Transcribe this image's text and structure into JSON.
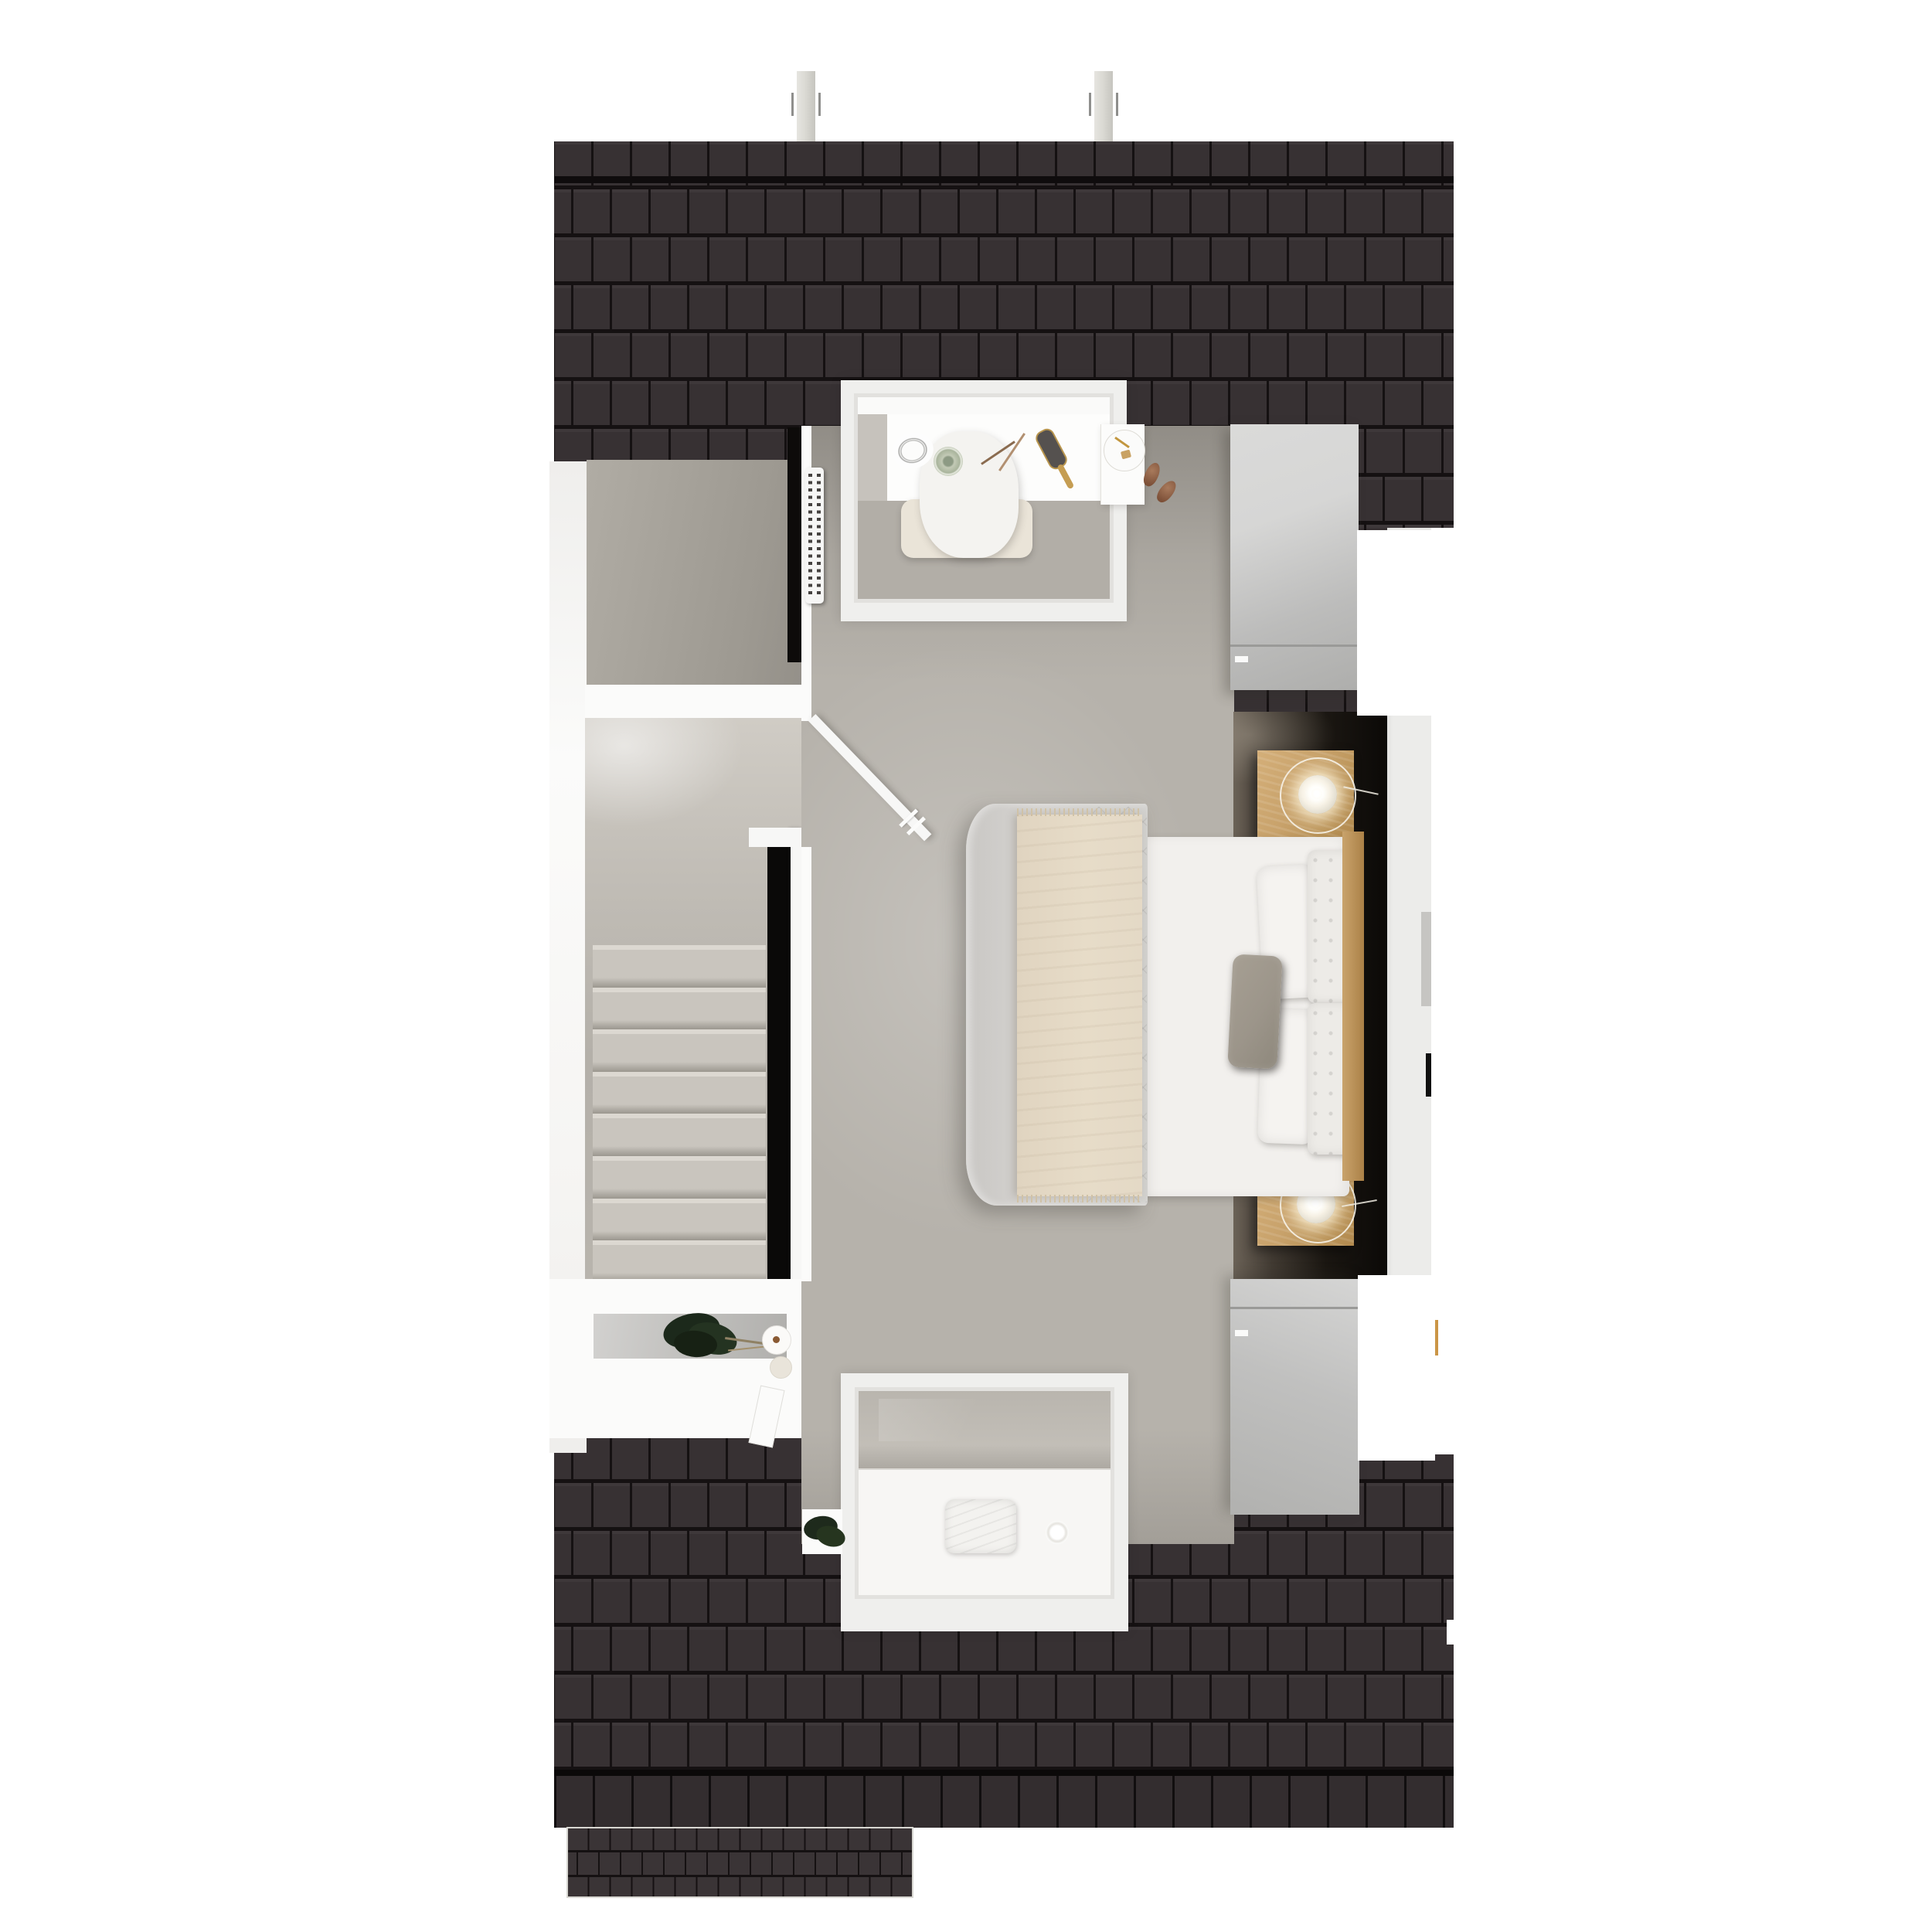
{
  "scene": {
    "type": "floor-plan-3d-render",
    "view": "top-down dollhouse",
    "floor": "attic level",
    "rooms": [
      "bedroom",
      "stair-hall",
      "closet-storage-room"
    ],
    "furniture": [
      "double-bed",
      "quilted-duvet",
      "cream-throw-blanket",
      "white-pillows",
      "tufted-headboard-cushions",
      "gray-accent-pillow",
      "wood-headboard",
      "nightstand-top",
      "nightstand-bottom",
      "wire-globe-lamp-top",
      "wire-globe-lamp-bottom",
      "wardrobe-top-right",
      "wardrobe-bottom-right",
      "vanity-desk",
      "vanity-chair",
      "woven-basket",
      "teacup",
      "pencils",
      "hairbrush",
      "jewelry-tray",
      "slippers",
      "white-dresser",
      "potted-plant",
      "candles",
      "book",
      "radiator",
      "staircase-8-treads",
      "stairwell-void",
      "stair-railing",
      "open-door",
      "dormer-window-top",
      "dormer-window-bottom",
      "window-bench-cushion",
      "bowl",
      "roof-vent-pipe-left",
      "roof-vent-pipe-right"
    ]
  },
  "colors": {
    "page_bg": "#ffffff",
    "roof_tile": "#373133",
    "roof_gap": "#151112",
    "chimney": "#dcdbd5",
    "wall_white": "#f4f3f1",
    "floor_bedroom": "#b6b2ab",
    "floor_closet": "#a7a39d",
    "floor_hall": "#c2beb7",
    "void_black": "#0a0908",
    "recess_dark": "#0b0907",
    "nightstand_wood": "#c8a26b",
    "headboard_wood": "#ab8147",
    "duvet": "#d6d4d1",
    "throw": "#e7dcc8",
    "mattress": "#f2f0ed",
    "pillow_gray": "#9c958a",
    "wardrobe_gray": "#c6c6c5",
    "plant_green": "#22301f",
    "lamp_glow": "#fff6dd",
    "cup_green": "#a9b49c",
    "shoe_brown": "#96684e",
    "tray_gold": "#c2963e",
    "orange_mark": "#cb9647",
    "wall_tint": "#ececea"
  }
}
